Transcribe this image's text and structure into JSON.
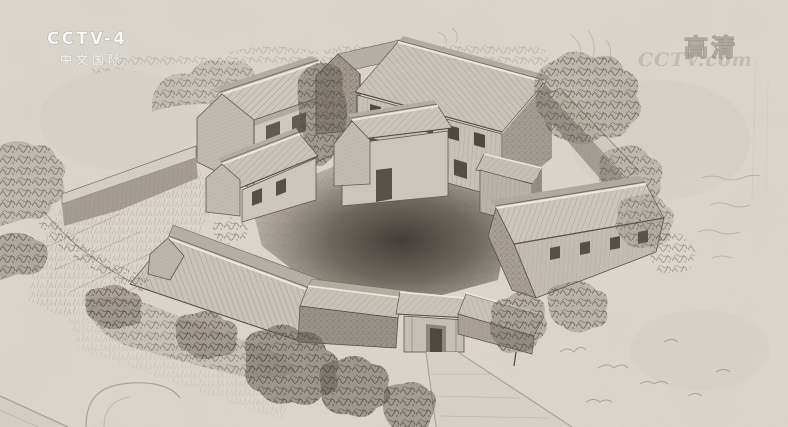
{
  "watermarks": {
    "channel_logo": {
      "line1": "CCTV-4",
      "line2": "中文国际"
    },
    "hd_badge": "高清",
    "site_watermark": "CCTV.com"
  },
  "scene": {
    "title": "Pencil sketch — aerial view of a walled courtyard farmstead",
    "labels": {
      "paper": "toned sketch paper",
      "treeline": "faint background tree line",
      "house_nw": "two-storey gabled house, north-west corner",
      "house_north_tall": "tall shaded gable wing, north",
      "house_ne": "large two-storey plank house, north-east",
      "cottage_center": "small cottage with door, centre of yard",
      "cottage_west": "small cottage with two windows, west",
      "hall_east": "long eastern hall with attic windows",
      "tower_east": "two-storey corner annex, east",
      "wing_sw": "long south-west wing",
      "wall_nw": "north-west enclosure wall",
      "wall_east": "eastern enclosure wall",
      "gatehouse": "entrance gatehouse with doorway, south",
      "gate_wing_left": "roofed wall left of gate",
      "gate_wing_right": "roofed wall right of gate",
      "courtyard": "central courtyard in deep shadow",
      "path": "footpath leading away from the gate",
      "vegetation": "hatched bushes, trees and grass around the compound",
      "road": "faint lane at lower left corner"
    }
  },
  "colors": {
    "paper": "#ded9d0",
    "pencil_dark": "#3d3831",
    "pencil_mid": "#6e675d",
    "pencil_light": "#b5afa3",
    "courtyard_shadow": "#413d37",
    "watermark_white": "#ffffff"
  }
}
